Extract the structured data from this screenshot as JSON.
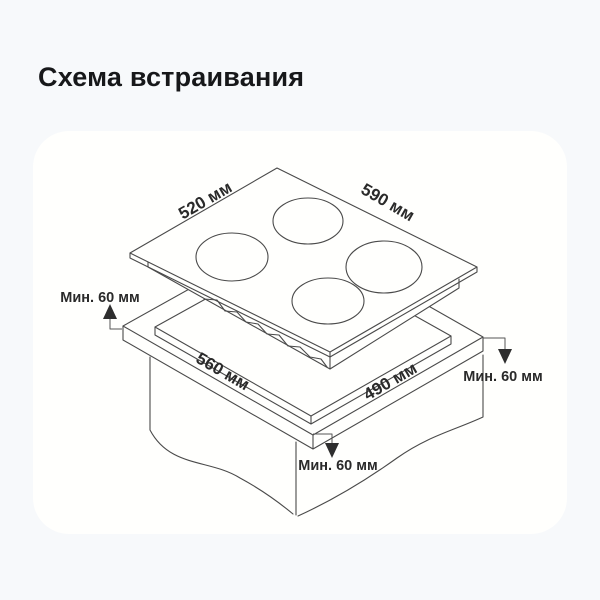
{
  "header": {
    "title": "Схема встраивания"
  },
  "diagram": {
    "dimension_labels": {
      "cooktop_top_left_edge": "520 мм",
      "cooktop_top_right_edge": "590 мм",
      "cutout_front_left_edge": "560 мм",
      "cutout_front_right_edge": "490 мм"
    },
    "clearance_labels": {
      "left": "Мин. 60 мм",
      "right": "Мин. 60 мм",
      "bottom": "Мин. 60 мм"
    },
    "colors": {
      "page_background": "#f7f9fb",
      "card_background": "#fffffd",
      "line": "#4a4a4a",
      "arrow": "#2e2e2e",
      "text": "#2a2a2a"
    }
  }
}
